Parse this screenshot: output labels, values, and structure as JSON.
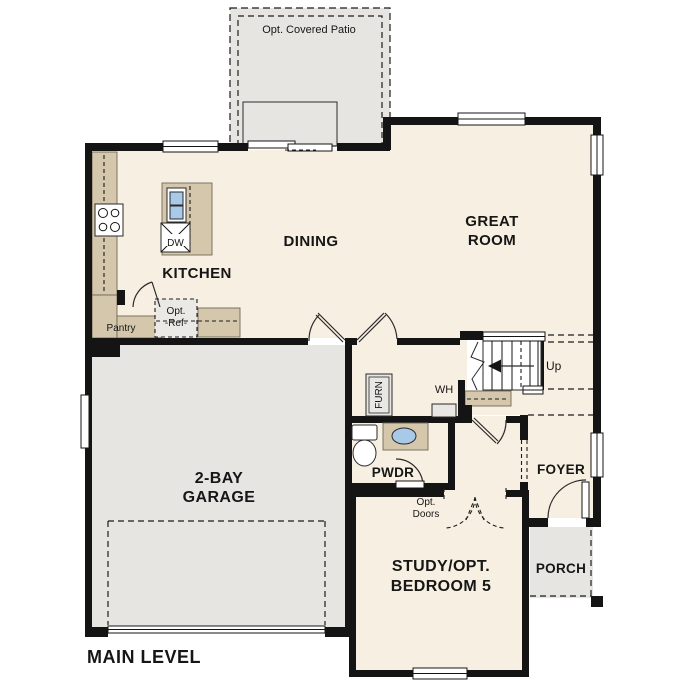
{
  "plan_title": "MAIN LEVEL",
  "rooms": {
    "patio": "Opt. Covered Patio",
    "kitchen": "KITCHEN",
    "dining": "DINING",
    "great_room_line1": "GREAT",
    "great_room_line2": "ROOM",
    "garage_line1": "2-BAY",
    "garage_line2": "GARAGE",
    "study_line1": "STUDY/OPT.",
    "study_line2": "BEDROOM 5",
    "foyer": "FOYER",
    "porch": "PORCH",
    "powder": "PWDR"
  },
  "annotations": {
    "pantry": "Pantry",
    "opt_ref_line1": "Opt.",
    "opt_ref_line2": "-Ref-",
    "dishwasher": "DW",
    "furnace": "FURN",
    "water_heater": "WH",
    "stairs_up": "Up",
    "opt_doors_line1": "Opt.",
    "opt_doors_line2": "Doors"
  },
  "colors": {
    "floor": "#f7efe1",
    "exterior_area": "#e6e5e2",
    "counter": "#d5c7ab",
    "wall": "#141414",
    "sink": "#a9c9e9",
    "background": "#ffffff"
  }
}
